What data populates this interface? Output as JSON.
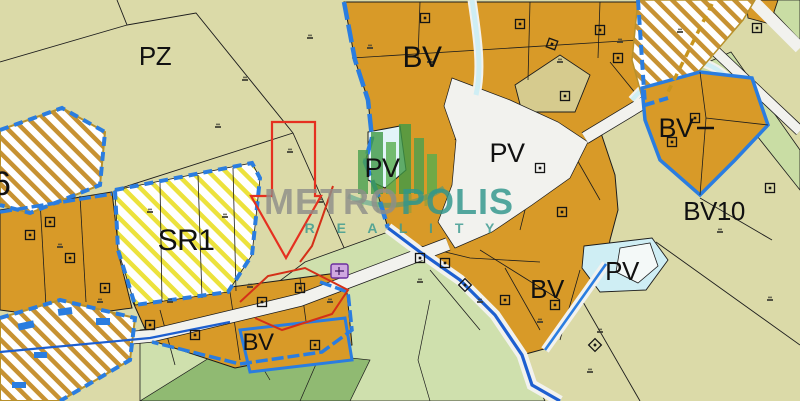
{
  "map": {
    "type": "land-use-zoning-map",
    "zones": {
      "pz": "PZ",
      "bv_top": "BV",
      "bv_right": "BV",
      "bv10": "BV10",
      "bv_south": "BV",
      "bv_southwest": "BV",
      "sr1": "SR1",
      "zone6": "6",
      "pv_pond": "PV",
      "pv_center": "PV",
      "pv_east": "PV"
    },
    "watermark": {
      "brand_gray": "METRO",
      "brand_teal": "POLIS",
      "subtitle": "R E A L I T Y"
    },
    "colors": {
      "parcel_orange": "#d89a28",
      "background_khaki": "#dbdaa8",
      "water_cyan": "#cfeef4",
      "green_light": "#cfe0ad",
      "green_dark": "#90ba72",
      "boundary_blue": "#2a7de0",
      "stream_blue": "#1d5fd0",
      "highlight_red": "#e03020",
      "hatch_gold": "#c79232",
      "hatch_yellow": "#ece23c",
      "road_white": "#f2f2ee",
      "watermark_teal": "#2f968c",
      "watermark_gray": "#8f8f8a"
    }
  }
}
